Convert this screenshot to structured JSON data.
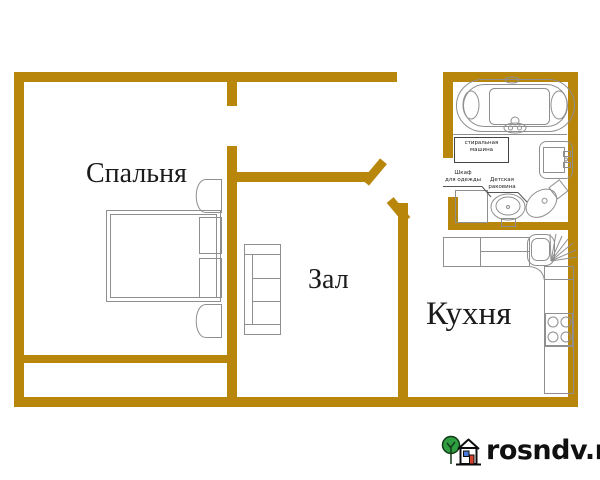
{
  "rooms": {
    "bedroom_label": "Спальня",
    "hall_label": "Зал",
    "kitchen_label": "Кухня"
  },
  "annotations": {
    "washing_machine": {
      "line1": "стиральная",
      "line2": "машина"
    },
    "wardrobe": {
      "line1": "Шкаф",
      "line2": "для одежды"
    },
    "child_sink": {
      "line1": "Детская",
      "line2": "раковина"
    }
  },
  "fixtures": [
    "double-bed",
    "pillows",
    "nightstand-top",
    "nightstand-bottom",
    "sofa",
    "jacuzzi-bathtub",
    "wall-sink",
    "wardrobe-box",
    "pedestal-child-sink",
    "toilet",
    "kitchen-counter",
    "corner-sink",
    "dish-drainer",
    "stove-4-burners"
  ],
  "watermark": {
    "text": "rosndv.ru"
  },
  "colors": {
    "wall": "#B8860B",
    "fixture_line": "#8f8f8f",
    "label_text": "#1b1b1b",
    "logo_green": "#2f9e41",
    "logo_red": "#d8402a",
    "logo_blue": "#4a79d8"
  }
}
